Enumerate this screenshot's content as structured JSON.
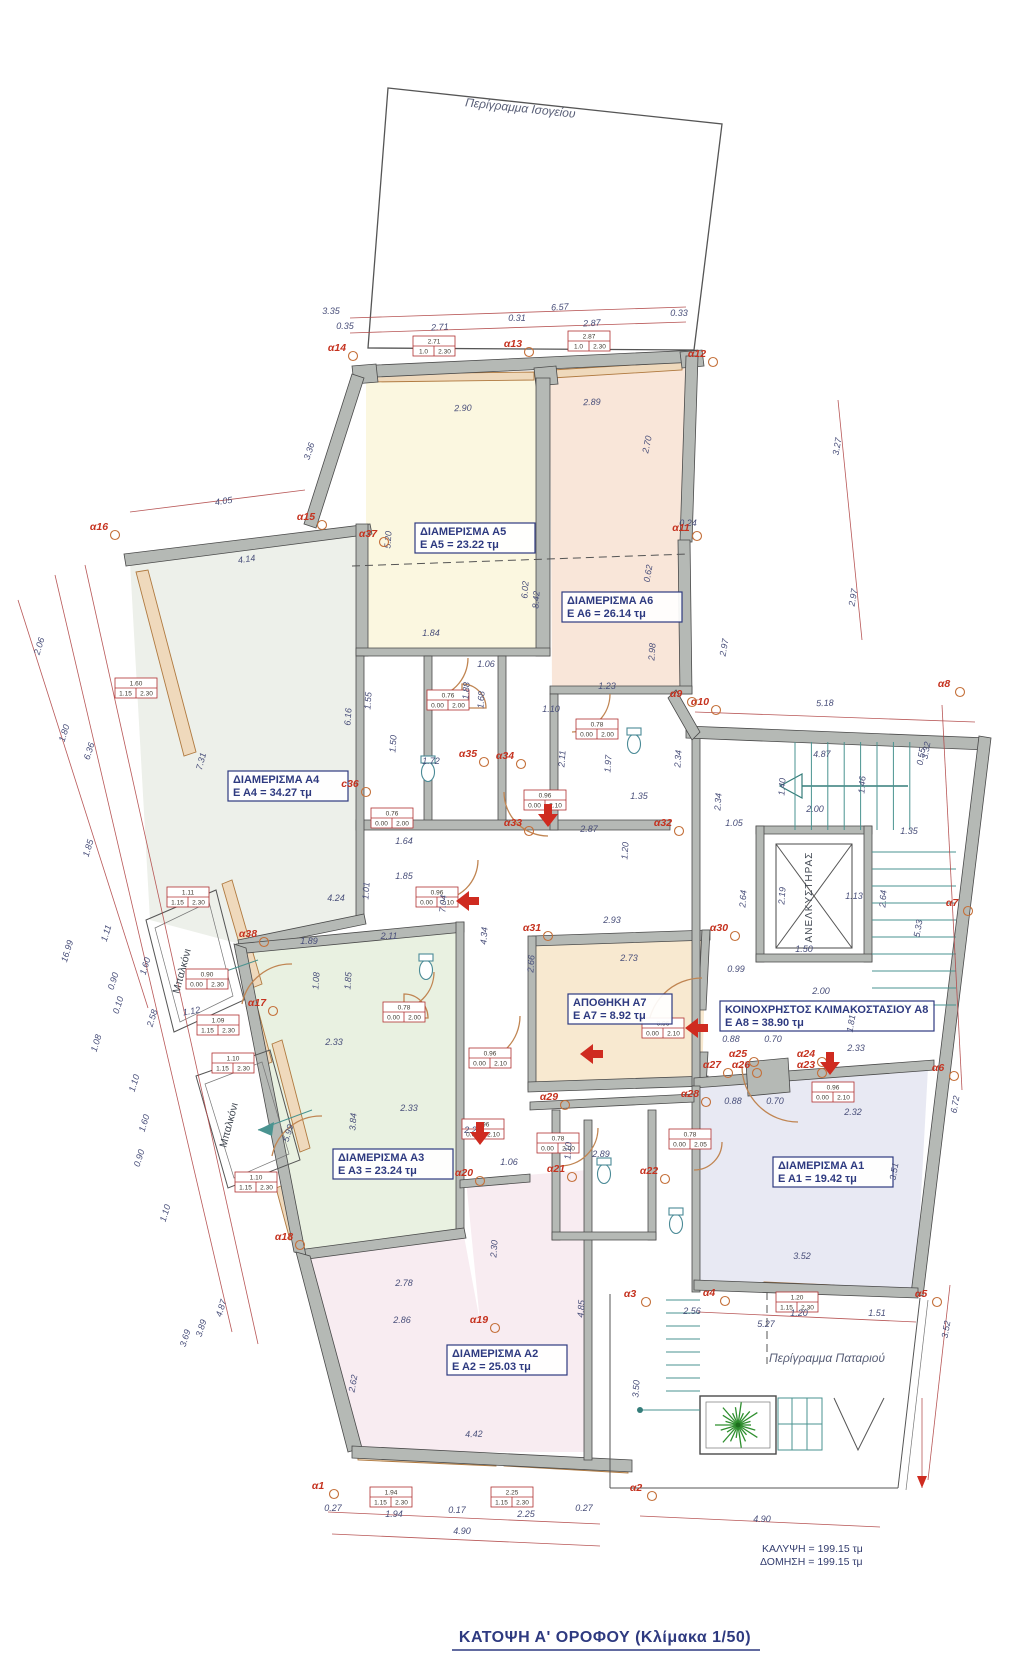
{
  "titles": {
    "main": "ΚΑΤΟΨΗ  Α'  ΟΡΟΦΟΥ (Κλίμακα 1/50)",
    "ground_outline": "Περίγραμμα Ισογείου",
    "loft_outline": "Περίγραμμα Παταριού",
    "coverage": "ΚΑΛΥΨΗ = 199.15 τμ",
    "construction": "ΔΟΜΗΣΗ = 199.15 τμ",
    "elevator": "ΑΝΕΛΚΥΣΤΗΡΑΣ",
    "balcony1": "Μπαλκόνι",
    "balcony2": "Μπαλκόνι"
  },
  "colors": {
    "wall": "#b5b9b5",
    "accent_red": "#cf2b20",
    "dim_red": "#b04545",
    "navy": "#2e3a80",
    "marker_red": "#c5321f",
    "teal": "#4a9390",
    "tan": "#c08552",
    "a5_fill": "#fbf7e0",
    "a6_fill": "#f9e6d9",
    "a4_fill": "#edf0ea",
    "a7_fill": "#f8e9d0",
    "a3_fill": "#e9f1e1",
    "a1_fill": "#e8e9f3",
    "a2_fill": "#f8ecf1",
    "tree_green": "#2f8f2f"
  },
  "apartments": [
    {
      "name": "ΔΙΑΜΕΡΙΣΜΑ  Α5",
      "area": "Ε Α5 = 23.22 τμ",
      "x": 475,
      "y": 538,
      "w": 120
    },
    {
      "name": "ΔΙΑΜΕΡΙΣΜΑ  Α6",
      "area": "Ε Α6 = 26.14 τμ",
      "x": 622,
      "y": 607,
      "w": 120
    },
    {
      "name": "ΔΙΑΜΕΡΙΣΜΑ  Α4",
      "area": "Ε Α4 = 34.27 τμ",
      "x": 288,
      "y": 786,
      "w": 120
    },
    {
      "name": "ΔΙΑΜΕΡΙΣΜΑ  Α3",
      "area": "Ε Α3 = 23.24 τμ",
      "x": 393,
      "y": 1164,
      "w": 120
    },
    {
      "name": "ΔΙΑΜΕΡΙΣΜΑ  Α1",
      "area": "Ε Α1 = 19.42 τμ",
      "x": 833,
      "y": 1172,
      "w": 120
    },
    {
      "name": "ΔΙΑΜΕΡΙΣΜΑ  Α2",
      "area": "Ε Α2 = 25.03 τμ",
      "x": 507,
      "y": 1360,
      "w": 120
    },
    {
      "name": "ΑΠΟΘΗΚΗ  Α7",
      "area": "Ε Α7 = 8.92 τμ",
      "x": 620,
      "y": 1009,
      "w": 104
    },
    {
      "name": "ΚΟΙΝΟΧΡΗΣΤΟΣ ΚΛΙΜΑΚΟΣΤΑΣΙΟΥ  Α8",
      "area": "Ε Α8 = 38.90 τμ",
      "x": 827,
      "y": 1016,
      "w": 214
    }
  ],
  "markers": [
    [
      "α14",
      337,
      351
    ],
    [
      "α13",
      513,
      347
    ],
    [
      "α12",
      697,
      357
    ],
    [
      "α15",
      306,
      520
    ],
    [
      "α16",
      99,
      530
    ],
    [
      "α37",
      368,
      537
    ],
    [
      "α11",
      681,
      531
    ],
    [
      "α10",
      700,
      705
    ],
    [
      "α9",
      676,
      697
    ],
    [
      "α8",
      944,
      687
    ],
    [
      "c36",
      350,
      787
    ],
    [
      "α35",
      468,
      757
    ],
    [
      "α34",
      505,
      759
    ],
    [
      "α33",
      513,
      826
    ],
    [
      "α32",
      663,
      826
    ],
    [
      "α31",
      532,
      931
    ],
    [
      "α30",
      719,
      931
    ],
    [
      "α7",
      952,
      906
    ],
    [
      "α38",
      248,
      937
    ],
    [
      "α17",
      257,
      1006
    ],
    [
      "α29",
      549,
      1100
    ],
    [
      "α28",
      690,
      1097
    ],
    [
      "α27",
      712,
      1068
    ],
    [
      "α26",
      741,
      1068
    ],
    [
      "α25",
      738,
      1057
    ],
    [
      "α24",
      806,
      1057
    ],
    [
      "α23",
      806,
      1068
    ],
    [
      "α6",
      938,
      1071
    ],
    [
      "α20",
      464,
      1176
    ],
    [
      "α21",
      556,
      1172
    ],
    [
      "α22",
      649,
      1174
    ],
    [
      "α18",
      284,
      1240
    ],
    [
      "α19",
      479,
      1323
    ],
    [
      "α3",
      630,
      1297
    ],
    [
      "α4",
      709,
      1296
    ],
    [
      "α5",
      921,
      1297
    ],
    [
      "α2",
      636,
      1491
    ],
    [
      "α1",
      318,
      1489
    ]
  ],
  "dimensions": [
    [
      "6.57",
      560,
      310,
      -3
    ],
    [
      "3.35",
      331,
      314,
      0
    ],
    [
      "0.35",
      345,
      329,
      0
    ],
    [
      "2.71",
      440,
      330,
      -3
    ],
    [
      "0.31",
      517,
      321,
      0
    ],
    [
      "2.87",
      592,
      326,
      -3
    ],
    [
      "0.33",
      679,
      316,
      0
    ],
    [
      "2.90",
      463,
      411,
      -2
    ],
    [
      "2.89",
      592,
      405,
      -2
    ],
    [
      "3.36",
      312,
      452,
      -72
    ],
    [
      "4.05",
      224,
      504,
      -8
    ],
    [
      "4.14",
      247,
      562,
      -8
    ],
    [
      "5.20",
      391,
      540,
      -86
    ],
    [
      "6.02",
      528,
      590,
      -86
    ],
    [
      "8.42",
      539,
      600,
      -86
    ],
    [
      "2.70",
      650,
      445,
      -78
    ],
    [
      "0.62",
      651,
      574,
      -80
    ],
    [
      "0.24",
      688,
      526,
      0
    ],
    [
      "2.98",
      655,
      652,
      -86
    ],
    [
      "2.97",
      727,
      648,
      -80
    ],
    [
      "3.27",
      840,
      447,
      -80
    ],
    [
      "2.97",
      856,
      598,
      -80
    ],
    [
      "3.32",
      929,
      751,
      -80
    ],
    [
      "1.84",
      431,
      636,
      0
    ],
    [
      "1.06",
      486,
      667,
      0
    ],
    [
      "1.88",
      469,
      691,
      -86
    ],
    [
      "1.68",
      484,
      700,
      -86
    ],
    [
      "1.55",
      371,
      701,
      -86
    ],
    [
      "6.16",
      351,
      717,
      -86
    ],
    [
      "1.50",
      396,
      744,
      -86
    ],
    [
      "1.72",
      431,
      764,
      0
    ],
    [
      "7.31",
      204,
      762,
      -75
    ],
    [
      "1.10",
      551,
      712,
      0
    ],
    [
      "1.23",
      607,
      689,
      0
    ],
    [
      "2.11",
      565,
      759,
      -86
    ],
    [
      "1.97",
      611,
      764,
      -86
    ],
    [
      "2.34",
      681,
      759,
      -86
    ],
    [
      "1.35",
      639,
      799,
      0
    ],
    [
      "2.87",
      589,
      832,
      0
    ],
    [
      "1.20",
      628,
      851,
      -86
    ],
    [
      "1.64",
      404,
      844,
      0
    ],
    [
      "1.85",
      404,
      879,
      0
    ],
    [
      "1.01",
      369,
      891,
      -86
    ],
    [
      "4.24",
      336,
      901,
      0
    ],
    [
      "7.04",
      446,
      904,
      -86
    ],
    [
      "4.34",
      487,
      936,
      -86
    ],
    [
      "1.89",
      309,
      944,
      0
    ],
    [
      "2.11",
      389,
      939,
      0
    ],
    [
      "1.08",
      319,
      981,
      -86
    ],
    [
      "1.85",
      351,
      981,
      -86
    ],
    [
      "2.33",
      334,
      1045,
      0
    ],
    [
      "5.99",
      291,
      1134,
      -73
    ],
    [
      "3.84",
      356,
      1122,
      -86
    ],
    [
      "2.20",
      473,
      1133,
      0
    ],
    [
      "2.33",
      409,
      1111,
      0
    ],
    [
      "1.06",
      509,
      1165,
      0
    ],
    [
      "1.10",
      571,
      1151,
      -86
    ],
    [
      "2.89",
      601,
      1157,
      0
    ],
    [
      "2.30",
      497,
      1249,
      -86
    ],
    [
      "5.18",
      825,
      706,
      -2
    ],
    [
      "4.87",
      822,
      757,
      -2
    ],
    [
      "0.55",
      924,
      757,
      -80
    ],
    [
      "1.40",
      785,
      787,
      -86
    ],
    [
      "1.46",
      865,
      785,
      -86
    ],
    [
      "2.00",
      815,
      812,
      0
    ],
    [
      "2.34",
      721,
      802,
      -86
    ],
    [
      "1.05",
      734,
      826,
      0
    ],
    [
      "1.35",
      909,
      834,
      0
    ],
    [
      "2.64",
      746,
      899,
      -86
    ],
    [
      "2.19",
      785,
      896,
      -86
    ],
    [
      "2.64",
      886,
      899,
      -86
    ],
    [
      "5.33",
      921,
      929,
      -80
    ],
    [
      "1.50",
      804,
      952,
      0
    ],
    [
      "1.13",
      854,
      899,
      0
    ],
    [
      "2.93",
      612,
      923,
      0
    ],
    [
      "2.73",
      629,
      961,
      0
    ],
    [
      "0.99",
      736,
      972,
      0
    ],
    [
      "2.00",
      821,
      994,
      0
    ],
    [
      "2.66",
      534,
      964,
      -86
    ],
    [
      "1.81",
      854,
      1024,
      -80
    ],
    [
      "2.33",
      856,
      1051,
      0
    ],
    [
      "0.88",
      731,
      1042,
      0
    ],
    [
      "0.70",
      773,
      1042,
      0
    ],
    [
      "0.88",
      733,
      1104,
      0
    ],
    [
      "0.70",
      775,
      1104,
      0
    ],
    [
      "2.32",
      853,
      1115,
      0
    ],
    [
      "6.72",
      958,
      1105,
      -80
    ],
    [
      "3.51",
      897,
      1172,
      -80
    ],
    [
      "2.78",
      404,
      1286,
      0
    ],
    [
      "2.86",
      402,
      1323,
      0
    ],
    [
      "4.85",
      584,
      1309,
      -86
    ],
    [
      "3.50",
      639,
      1389,
      -86
    ],
    [
      "2.62",
      356,
      1384,
      -80
    ],
    [
      "4.42",
      474,
      1437,
      -2
    ],
    [
      "3.52",
      802,
      1259,
      0
    ],
    [
      "2.56",
      692,
      1314,
      0
    ],
    [
      "1.20",
      799,
      1316,
      0
    ],
    [
      "1.51",
      877,
      1316,
      0
    ],
    [
      "5.27",
      766,
      1327,
      0
    ],
    [
      "3.52",
      949,
      1330,
      -80
    ],
    [
      "0.27",
      333,
      1511,
      0
    ],
    [
      "1.94",
      394,
      1517,
      0
    ],
    [
      "0.17",
      457,
      1513,
      0
    ],
    [
      "2.25",
      526,
      1517,
      0
    ],
    [
      "0.27",
      584,
      1511,
      0
    ],
    [
      "4.90",
      462,
      1534,
      0
    ],
    [
      "4.90",
      762,
      1522,
      0
    ],
    [
      "2.06",
      42,
      647,
      -73
    ],
    [
      "1.80",
      67,
      734,
      -73
    ],
    [
      "6.36",
      92,
      752,
      -73
    ],
    [
      "1.85",
      91,
      849,
      -73
    ],
    [
      "16.99",
      70,
      952,
      -73
    ],
    [
      "1.11",
      109,
      934,
      -73
    ],
    [
      "0.90",
      116,
      982,
      -73
    ],
    [
      "0.10",
      121,
      1006,
      -73
    ],
    [
      "1.08",
      99,
      1044,
      -73
    ],
    [
      "2.58",
      155,
      1019,
      -73
    ],
    [
      "1.12",
      192,
      1014,
      -10
    ],
    [
      "1.10",
      137,
      1084,
      -73
    ],
    [
      "1.60",
      147,
      1124,
      -73
    ],
    [
      "0.90",
      142,
      1159,
      -73
    ],
    [
      "1.10",
      168,
      1214,
      -73
    ],
    [
      "1.60",
      148,
      967,
      -73
    ],
    [
      "4.87",
      224,
      1309,
      -73
    ],
    [
      "3.89",
      204,
      1329,
      -73
    ],
    [
      "3.69",
      188,
      1339,
      -73
    ]
  ],
  "spec_boxes": [
    [
      "2.71",
      "1.0",
      "2.30",
      434,
      346
    ],
    [
      "2.87",
      "1.0",
      "2.30",
      589,
      341
    ],
    [
      "1.60",
      "1.15",
      "2.30",
      136,
      688
    ],
    [
      "1.11",
      "1.15",
      "2.30",
      188,
      897
    ],
    [
      "0.90",
      "0.00",
      "2.30",
      207,
      979
    ],
    [
      "1.09",
      "1.15",
      "2.30",
      218,
      1025
    ],
    [
      "1.10",
      "1.15",
      "2.30",
      233,
      1063
    ],
    [
      "1.10",
      "1.15",
      "2.30",
      256,
      1182
    ],
    [
      "0.76",
      "0.00",
      "2.00",
      448,
      700
    ],
    [
      "0.76",
      "0.00",
      "2.00",
      392,
      818
    ],
    [
      "0.96",
      "0.00",
      "2.10",
      545,
      800
    ],
    [
      "0.78",
      "0.00",
      "2.00",
      597,
      729
    ],
    [
      "0.96",
      "0.00",
      "2.10",
      437,
      897
    ],
    [
      "0.96",
      "0.00",
      "2.10",
      490,
      1058
    ],
    [
      "0.78",
      "0.00",
      "2.00",
      404,
      1012
    ],
    [
      "0.96",
      "0.00",
      "2.10",
      663,
      1028
    ],
    [
      "0.96",
      "0.00",
      "2.10",
      833,
      1092
    ],
    [
      "0.78",
      "0.00",
      "2.05",
      690,
      1139
    ],
    [
      "0.78",
      "0.00",
      "2.00",
      558,
      1143
    ],
    [
      "1.20",
      "1.15",
      "2.30",
      797,
      1302
    ],
    [
      "1.94",
      "1.15",
      "2.30",
      391,
      1497
    ],
    [
      "2.25",
      "1.15",
      "2.30",
      512,
      1497
    ],
    [
      "0.96",
      "0.00",
      "2.10",
      483,
      1129
    ]
  ],
  "red_arrows": [
    [
      548,
      822,
      "d"
    ],
    [
      461,
      901,
      "l"
    ],
    [
      585,
      1054,
      "l"
    ],
    [
      690,
      1028,
      "l"
    ],
    [
      830,
      1070,
      "d"
    ],
    [
      480,
      1140,
      "d"
    ]
  ]
}
